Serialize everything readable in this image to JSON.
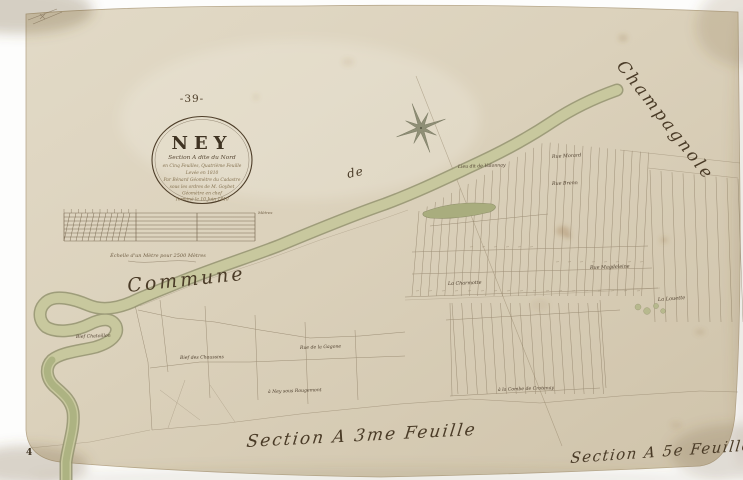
{
  "map": {
    "document_type": "cadastral map sheet (scanned)",
    "sheet_number": "-39-",
    "corner_page_number": "4",
    "cartouche": {
      "title": "NEY",
      "subtitle": "Section A dite du Nord",
      "lines": [
        "en Cinq Feuilles, Quatrième Feuille",
        "Levée en 1810",
        "Par Bénard Géomètre du Cadastre",
        "sous les ordres de M. Goybet",
        "Géomètre en chef",
        "Terminé le 10 Juin 1810"
      ]
    },
    "scale_bar": {
      "caption": "Échelle d'un Mètre pour 2500 Mètres",
      "unit_label": "Mètres"
    },
    "neighbor_commune": {
      "word1": "Commune",
      "word2": "de",
      "word3": "Champagnole"
    },
    "section_titles": [
      {
        "text": "Section A 3me Feuille"
      },
      {
        "text": "Section A 5e Feuille"
      }
    ],
    "place_labels": [
      {
        "text": "Lieu dit de Valonnay",
        "x": 458,
        "y": 168,
        "rot": -2,
        "size": 4.6
      },
      {
        "text": "Rue Morard",
        "x": 552,
        "y": 158,
        "rot": -3,
        "size": 4.8
      },
      {
        "text": "Rue Brenn",
        "x": 552,
        "y": 185,
        "rot": -2,
        "size": 4.8
      },
      {
        "text": "Rue Magdeleine",
        "x": 590,
        "y": 269,
        "rot": -2,
        "size": 4.8
      },
      {
        "text": "La Charmotte",
        "x": 448,
        "y": 285,
        "rot": -2,
        "size": 4.8
      },
      {
        "text": "La Louette",
        "x": 658,
        "y": 301,
        "rot": -4,
        "size": 5
      },
      {
        "text": "Bief Chatoillon",
        "x": 76,
        "y": 338,
        "rot": -2,
        "size": 4.6
      },
      {
        "text": "Rue de la Gagone",
        "x": 300,
        "y": 349,
        "rot": -2,
        "size": 4.6
      },
      {
        "text": "Bief des Chaussins",
        "x": 180,
        "y": 359,
        "rot": -1,
        "size": 4.6
      },
      {
        "text": "à Ney sous Rougemont",
        "x": 268,
        "y": 393,
        "rot": -2,
        "size": 4.6
      },
      {
        "text": "à la Combe de Crotenay",
        "x": 498,
        "y": 391,
        "rot": -2,
        "size": 4.6
      }
    ],
    "icons": {
      "compass": "eight-point-compass-star"
    },
    "palette": {
      "paper": "#d9cfb9",
      "ink": "#5b4a33",
      "faded_ink": "#84714f",
      "water_fill": "#c8c89e",
      "water_edge": "#9a9a73",
      "water_deep": "#aab07e"
    }
  }
}
